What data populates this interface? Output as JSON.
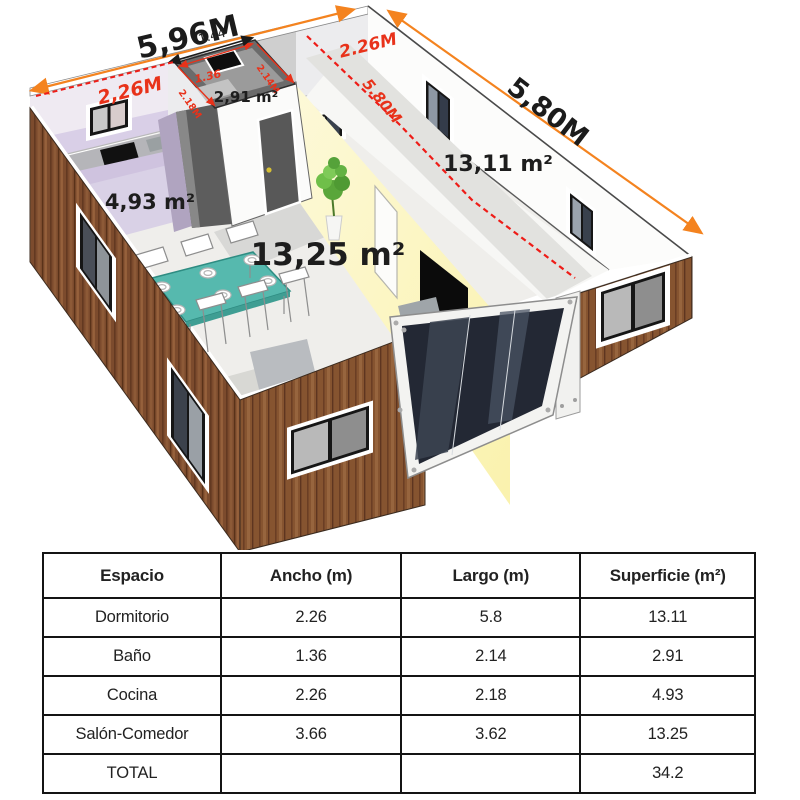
{
  "plan": {
    "labels": {
      "total_width": "5,96M",
      "kitchen_width": "2,26M",
      "bath_top": "1.44",
      "bath_width": "1.36",
      "bath_length": "2.14M",
      "kitchen_length": "2.18M",
      "bath_area": "2,91 m²",
      "bedroom_width": "2.26M",
      "total_length": "5,80M",
      "bedroom_length": "5.80M",
      "bedroom_area": "13,11 m²",
      "kitchen_area": "4,93 m²",
      "living_area": "13,25 m²"
    },
    "colors": {
      "accent_orange": "#f4831f",
      "dimension_red": "#e8321a",
      "wood": "#7c4b2d",
      "table_teal": "#56b9ae",
      "wall_yellow": "#fcf6c5",
      "wall_lavender": "#d9cfe7"
    }
  },
  "table": {
    "headers": [
      "Espacio",
      "Ancho (m)",
      "Largo (m)",
      "Superficie (m²)"
    ],
    "rows": [
      {
        "espacio": "Dormitorio",
        "ancho": "2.26",
        "largo": "5.8",
        "superficie": "13.11"
      },
      {
        "espacio": "Baño",
        "ancho": "1.36",
        "largo": "2.14",
        "superficie": "2.91"
      },
      {
        "espacio": "Cocina",
        "ancho": "2.26",
        "largo": "2.18",
        "superficie": "4.93"
      },
      {
        "espacio": "Salón-Comedor",
        "ancho": "3.66",
        "largo": "3.62",
        "superficie": "13.25"
      },
      {
        "espacio": "TOTAL",
        "ancho": "",
        "largo": "",
        "superficie": "34.2"
      }
    ]
  }
}
